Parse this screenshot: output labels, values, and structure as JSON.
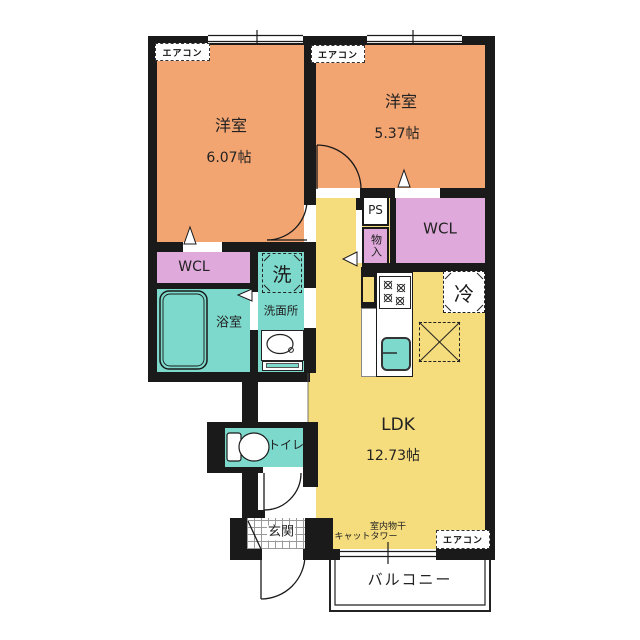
{
  "rooms": {
    "bedroom1": {
      "label": "洋室",
      "size": "6.07帖"
    },
    "bedroom2": {
      "label": "洋室",
      "size": "5.37帖"
    },
    "ldk": {
      "label": "LDK",
      "size": "12.73帖"
    },
    "wcl_left": {
      "label": "WCL"
    },
    "wcl_right": {
      "label": "WCL"
    },
    "bathroom": {
      "label": "浴室"
    },
    "washroom": {
      "label": "洗面所"
    },
    "toilet": {
      "label": "トイレ"
    },
    "entrance": {
      "label": "玄関"
    },
    "balcony": {
      "label": "バルコニー"
    },
    "storage": {
      "label": "物入"
    },
    "pipe_shaft": {
      "label": "PS"
    }
  },
  "fixtures": {
    "washer": {
      "label": "洗"
    },
    "fridge": {
      "label": "冷"
    }
  },
  "annotations": {
    "aircon": "エアコン",
    "indoor_drying": "室内物干",
    "cat_tower": "キャットタワー"
  },
  "colors": {
    "bedroom": "#F2A471",
    "closet": "#DFA9DB",
    "wet_area": "#7CD9CC",
    "ldk": "#F5DC7C",
    "wall": "#1A1A1A"
  }
}
